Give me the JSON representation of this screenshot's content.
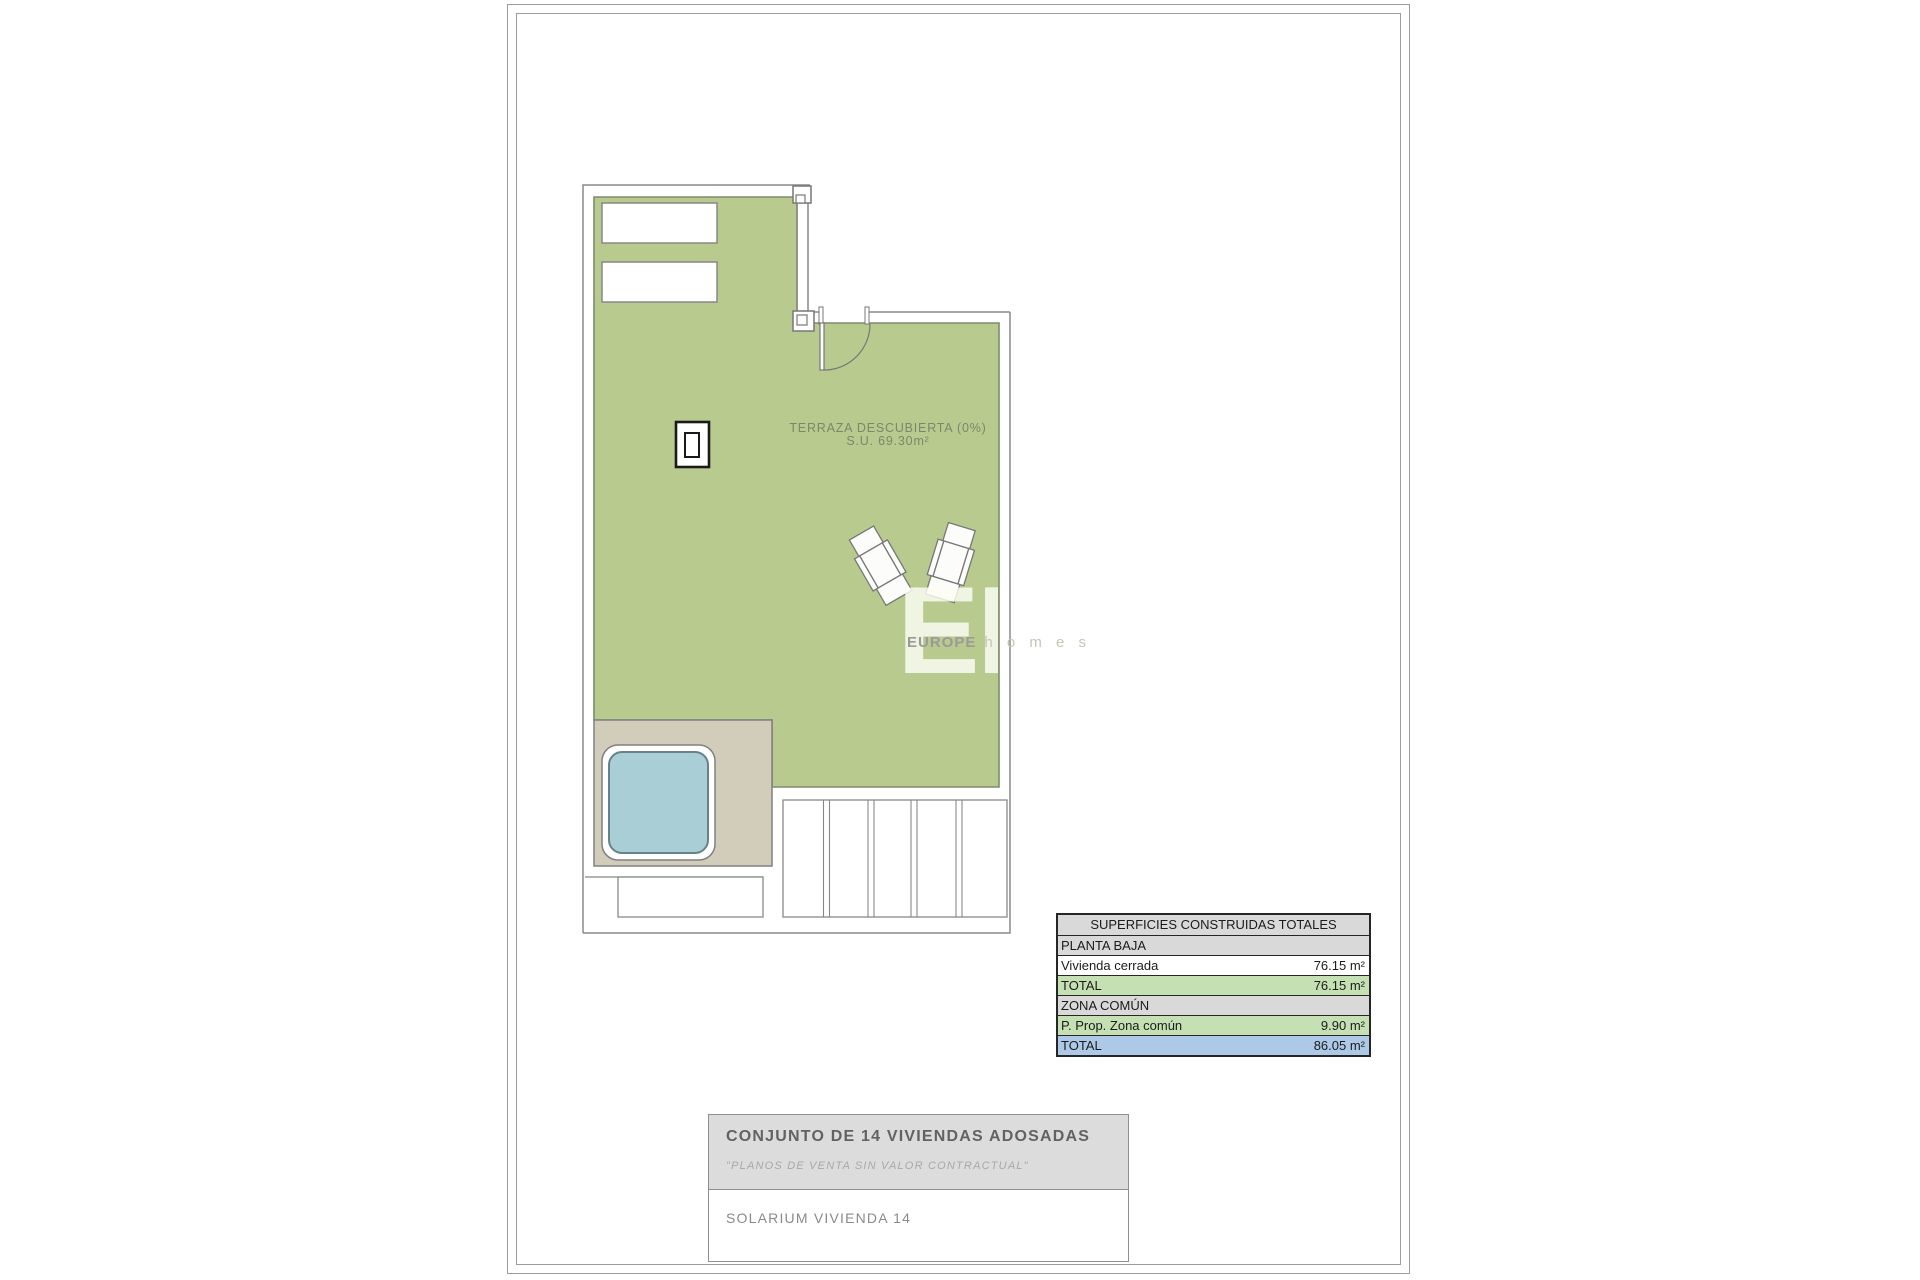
{
  "plan": {
    "terrace_label": "TERRAZA DESCUBIERTA (0%)",
    "terrace_area": "S.U. 69.30m²"
  },
  "watermark": {
    "initials": "EH",
    "brand_primary": "EUROPE",
    "brand_secondary": "h o m e s"
  },
  "areas_table": {
    "title": "SUPERFICIES CONSTRUIDAS TOTALES",
    "rows": [
      {
        "label": "PLANTA BAJA",
        "value": ""
      },
      {
        "label": "Vivienda cerrada",
        "value": "76.15 m²"
      },
      {
        "label": "TOTAL",
        "value": "76.15 m²"
      },
      {
        "label": "ZONA COMÚN",
        "value": ""
      },
      {
        "label": "P. Prop. Zona común",
        "value": "9.90 m²"
      },
      {
        "label": "TOTAL",
        "value": "86.05 m²"
      }
    ]
  },
  "title_block": {
    "project": "CONJUNTO DE 14 VIVIENDAS ADOSADAS",
    "disclaimer": "\"PLANOS DE VENTA SIN VALOR CONTRACTUAL\"",
    "sheet_name": "SOLARIUM VIVIENDA 14"
  },
  "colors": {
    "terrace_green": "#b8ca8e",
    "deck_beige": "#d2ccba",
    "pool_blue": "#a9ced5",
    "wall_gray": "#8a8a8a",
    "table_section_gray": "#d9d9d9",
    "table_subtotal_green": "#c5e0b3",
    "table_total_blue": "#aec9e8"
  }
}
